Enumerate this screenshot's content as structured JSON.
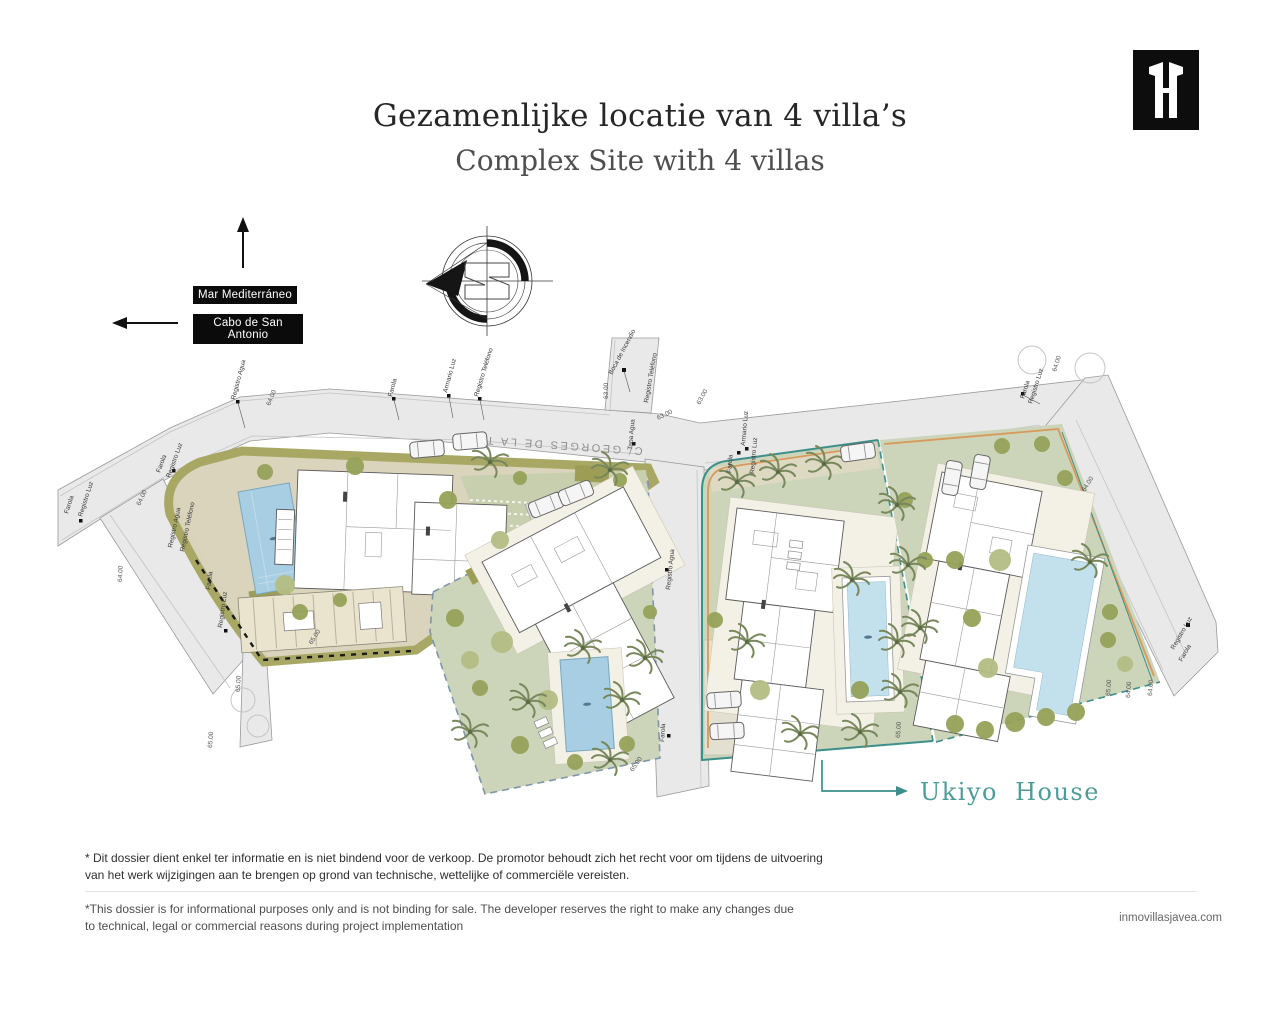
{
  "header": {
    "title_nl": "Gezamenlijke locatie van 4 villa’s",
    "title_en": "Complex Site with 4 villas"
  },
  "orientation": {
    "sea": "Mar Mediterráneo",
    "cape": "Cabo de San Antonio"
  },
  "plan": {
    "street": "C/ GEORGES DE LA TOUR",
    "highlight": "Ukiyo House",
    "labels": {
      "registro_agua": "Registro Agua",
      "farola": "Farola",
      "armario_luz": "Armario Luz",
      "registro_telefono": "Registro Teléfono",
      "boca_incendio": "Boca de Incendio",
      "tapa_agua": "Tapa Agua",
      "registro_luz": "Registro Luz"
    },
    "dims": {
      "d63": "63.00",
      "d64": "64.00",
      "d65": "65.00"
    },
    "colors": {
      "road": "#e9e9e9",
      "plot_green": "#ccd4ba",
      "terrace": "#d9d3ba",
      "lawn": "#c7cfae",
      "pool": "#a7cee2",
      "pool_light": "#c3e0ed",
      "boundary_teal": "#3d8f8b",
      "boundary_orange": "#d89a5a",
      "plot2_dash": "#7e96aa",
      "highlight_text": "#4e9c98"
    }
  },
  "footer": {
    "disclaimer_nl_1": "* Dit dossier dient enkel ter informatie en is niet bindend voor de verkoop. De promotor behoudt zich het recht voor om tijdens de uitvoering",
    "disclaimer_nl_2": "van het werk wijzigingen aan te brengen op grond van technische, wettelijke of commerciële vereisten.",
    "disclaimer_en_1": "*This dossier is for informational purposes only and is not binding for sale. The developer reserves the right to make any changes due",
    "disclaimer_en_2": "to technical, legal or commercial reasons during project implementation",
    "website": "inmovillasjavea.com"
  }
}
